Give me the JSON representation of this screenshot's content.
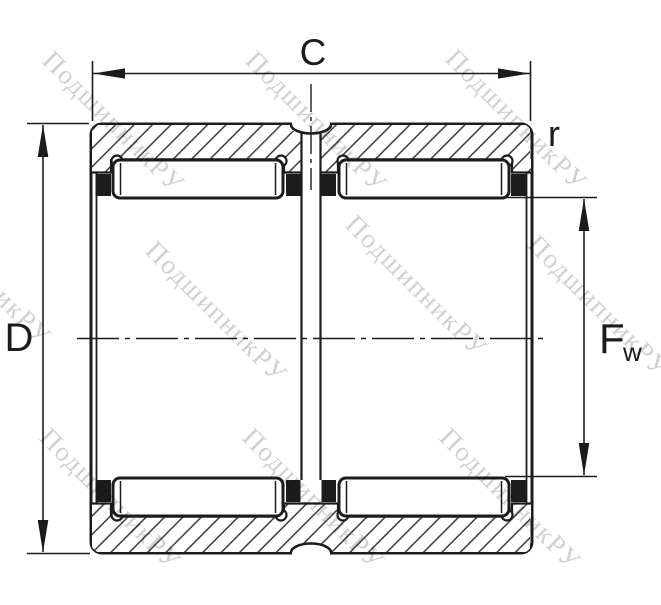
{
  "drawing": {
    "labels": {
      "width": "C",
      "corner_radius": "r",
      "outer_diameter": "D",
      "bore_diameter_main": "F",
      "bore_diameter_sub": "w"
    },
    "watermark": {
      "text": "ПодшипникРУ",
      "color": "#c8c8c8"
    },
    "colors": {
      "line": "#1c1c1c",
      "background": "#ffffff"
    }
  }
}
